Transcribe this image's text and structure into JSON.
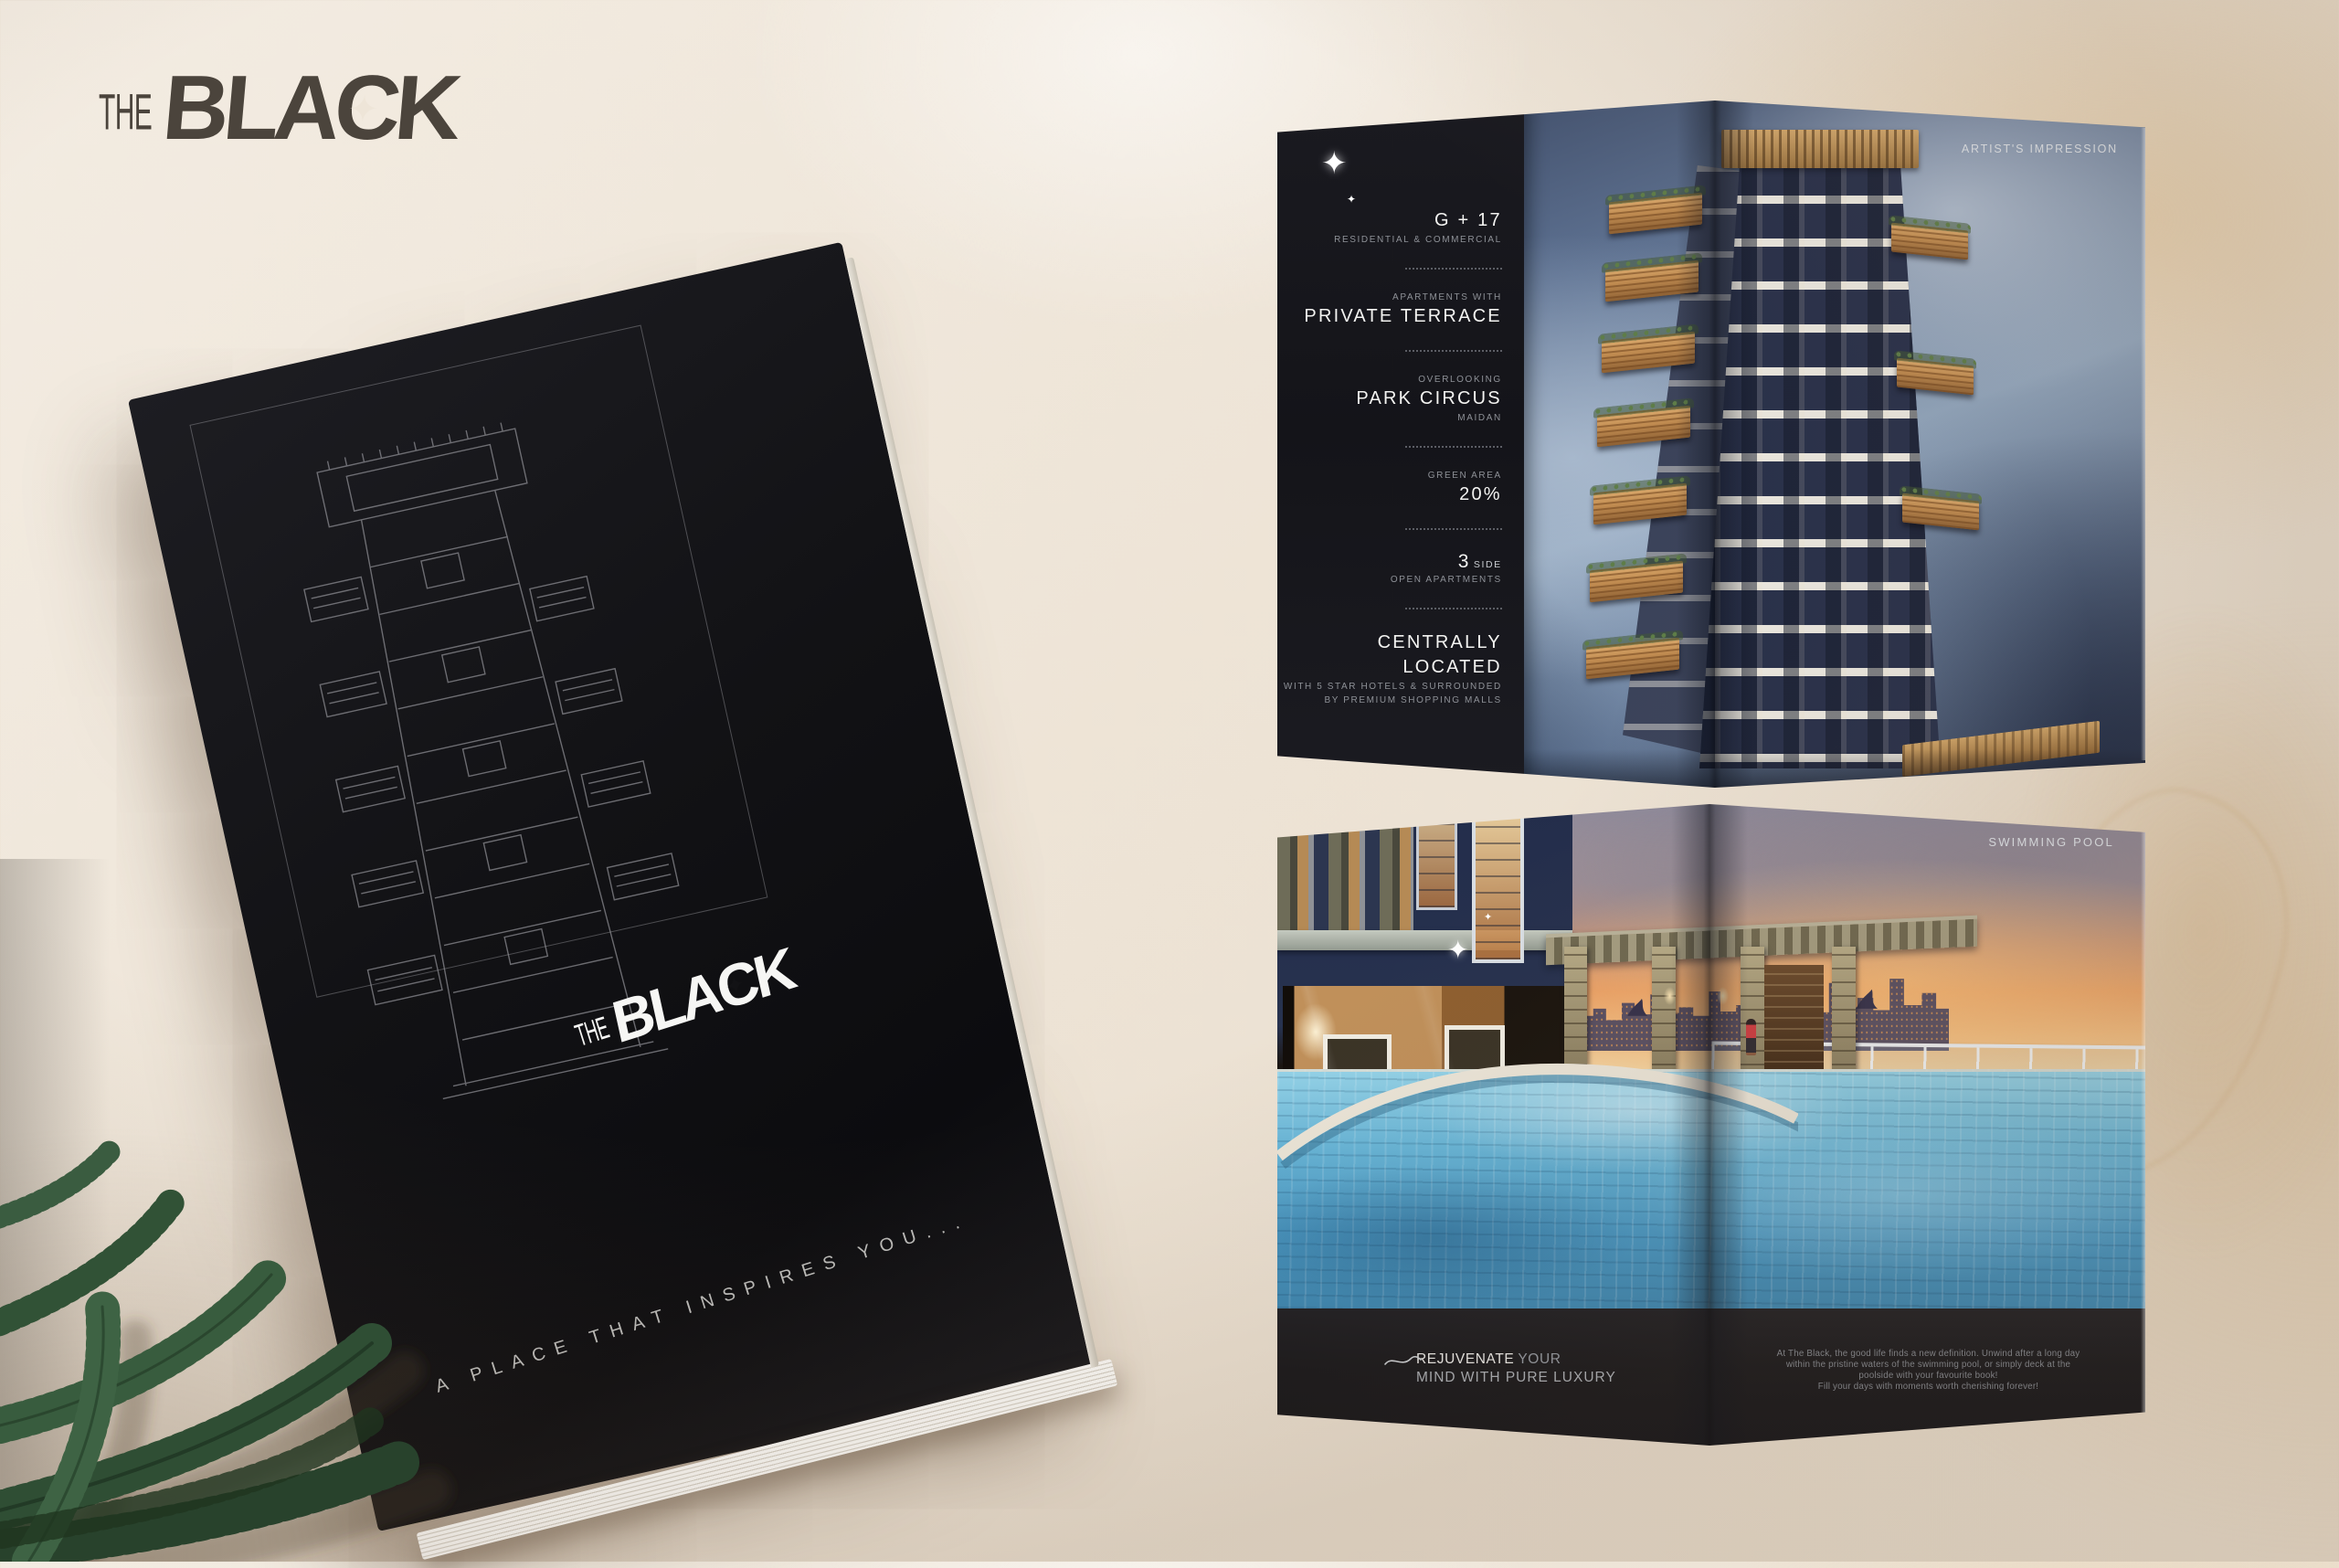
{
  "brand": {
    "the": "THE",
    "bla": "BLA",
    "c": "C",
    "k": "K"
  },
  "icons": {
    "sparkle": "✦",
    "plane": "✈"
  },
  "cover": {
    "tagline": "A PLACE THAT INSPIRES YOU..."
  },
  "spread_top": {
    "corner_label": "ARTIST'S IMPRESSION",
    "specs": {
      "floors_main": "G + 17",
      "floors_sub": "RESIDENTIAL & COMMERCIAL",
      "terrace_pre": "APARTMENTS WITH",
      "terrace_main": "PRIVATE TERRACE",
      "view_pre": "OVERLOOKING",
      "view_main": "PARK CIRCUS",
      "view_sub": "MAIDAN",
      "green_pre": "GREEN AREA",
      "green_main": "20%",
      "side_num": "3",
      "side_word": "SIDE",
      "side_sub": "OPEN APARTMENTS",
      "located_main": "CENTRALLY LOCATED",
      "located_sub1": "WITH 5 STAR HOTELS & SURROUNDED",
      "located_sub2": "BY PREMIUM SHOPPING MALLS"
    }
  },
  "spread_bottom": {
    "corner_label": "SWIMMING POOL",
    "headline_strong": "REJUVENATE",
    "headline_light": "YOUR",
    "headline_line2": "MIND WITH PURE LUXURY",
    "body_line1": "At The Black, the good life finds a new definition. Unwind after a long day",
    "body_line2": "within the pristine waters of the swimming pool, or simply deck at the",
    "body_line3": "poolside with your favourite book!",
    "body_line4": "Fill your days with moments worth cherishing forever!"
  },
  "colors": {
    "paper_background": "#eee5d8",
    "brochure_black": "#121215",
    "logo_gray": "#4b443c",
    "sky_blue": "#5e7292",
    "tower_navy": "#28304a",
    "balcony_tan": "#c08b50",
    "sunset_orange": "#ea9e64",
    "pool_blue": "#4f9cc8",
    "leaf_green": "#47643f"
  }
}
